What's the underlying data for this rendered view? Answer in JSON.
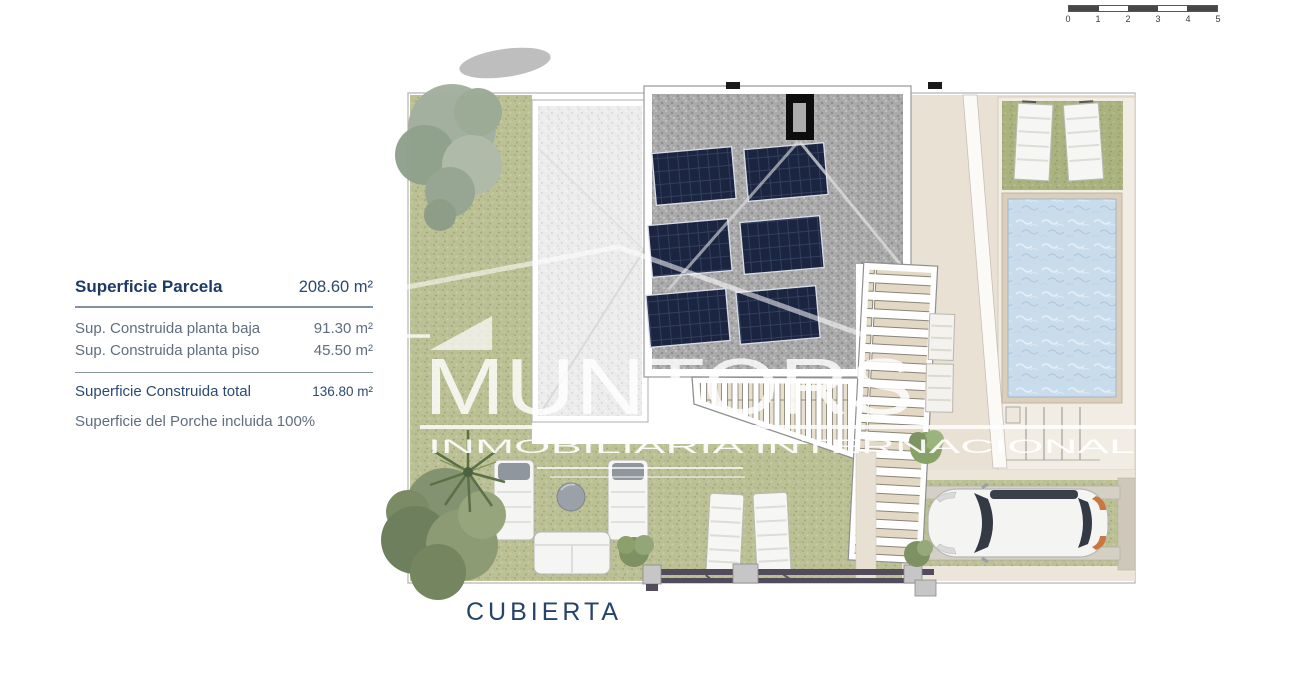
{
  "scale_bar": {
    "labels": [
      "0",
      "1",
      "2",
      "3",
      "4",
      "5"
    ]
  },
  "info_panel": {
    "title": {
      "label": "Superficie Parcela",
      "value": "208.60 m²"
    },
    "rows": [
      {
        "label": "Sup. Construida planta baja",
        "value": "91.30 m²"
      },
      {
        "label": "Sup. Construida planta piso",
        "value": "45.50 m²"
      }
    ],
    "total": {
      "label": "Superficie Construida total",
      "value": "136.80 m²"
    },
    "note": "Superficie del Porche incluida 100%"
  },
  "watermark": {
    "brand": "MUNTORS",
    "subtitle": "INMOBILIARIA INTERNACIONAL"
  },
  "plan": {
    "label": "CUBIERTA"
  },
  "colors": {
    "text_navy": "#1d3a66",
    "text_gray": "#5f6e7e",
    "lawn_green": "#bcc095",
    "gravel_dark": "#aaaaaa",
    "gravel_light": "#ececec",
    "solar_panel_navy": "#1b2540",
    "pool_water_blue": "#c9dcec",
    "terrace_beige": "#e9e1d4",
    "fence_dark": "#514b5c"
  }
}
